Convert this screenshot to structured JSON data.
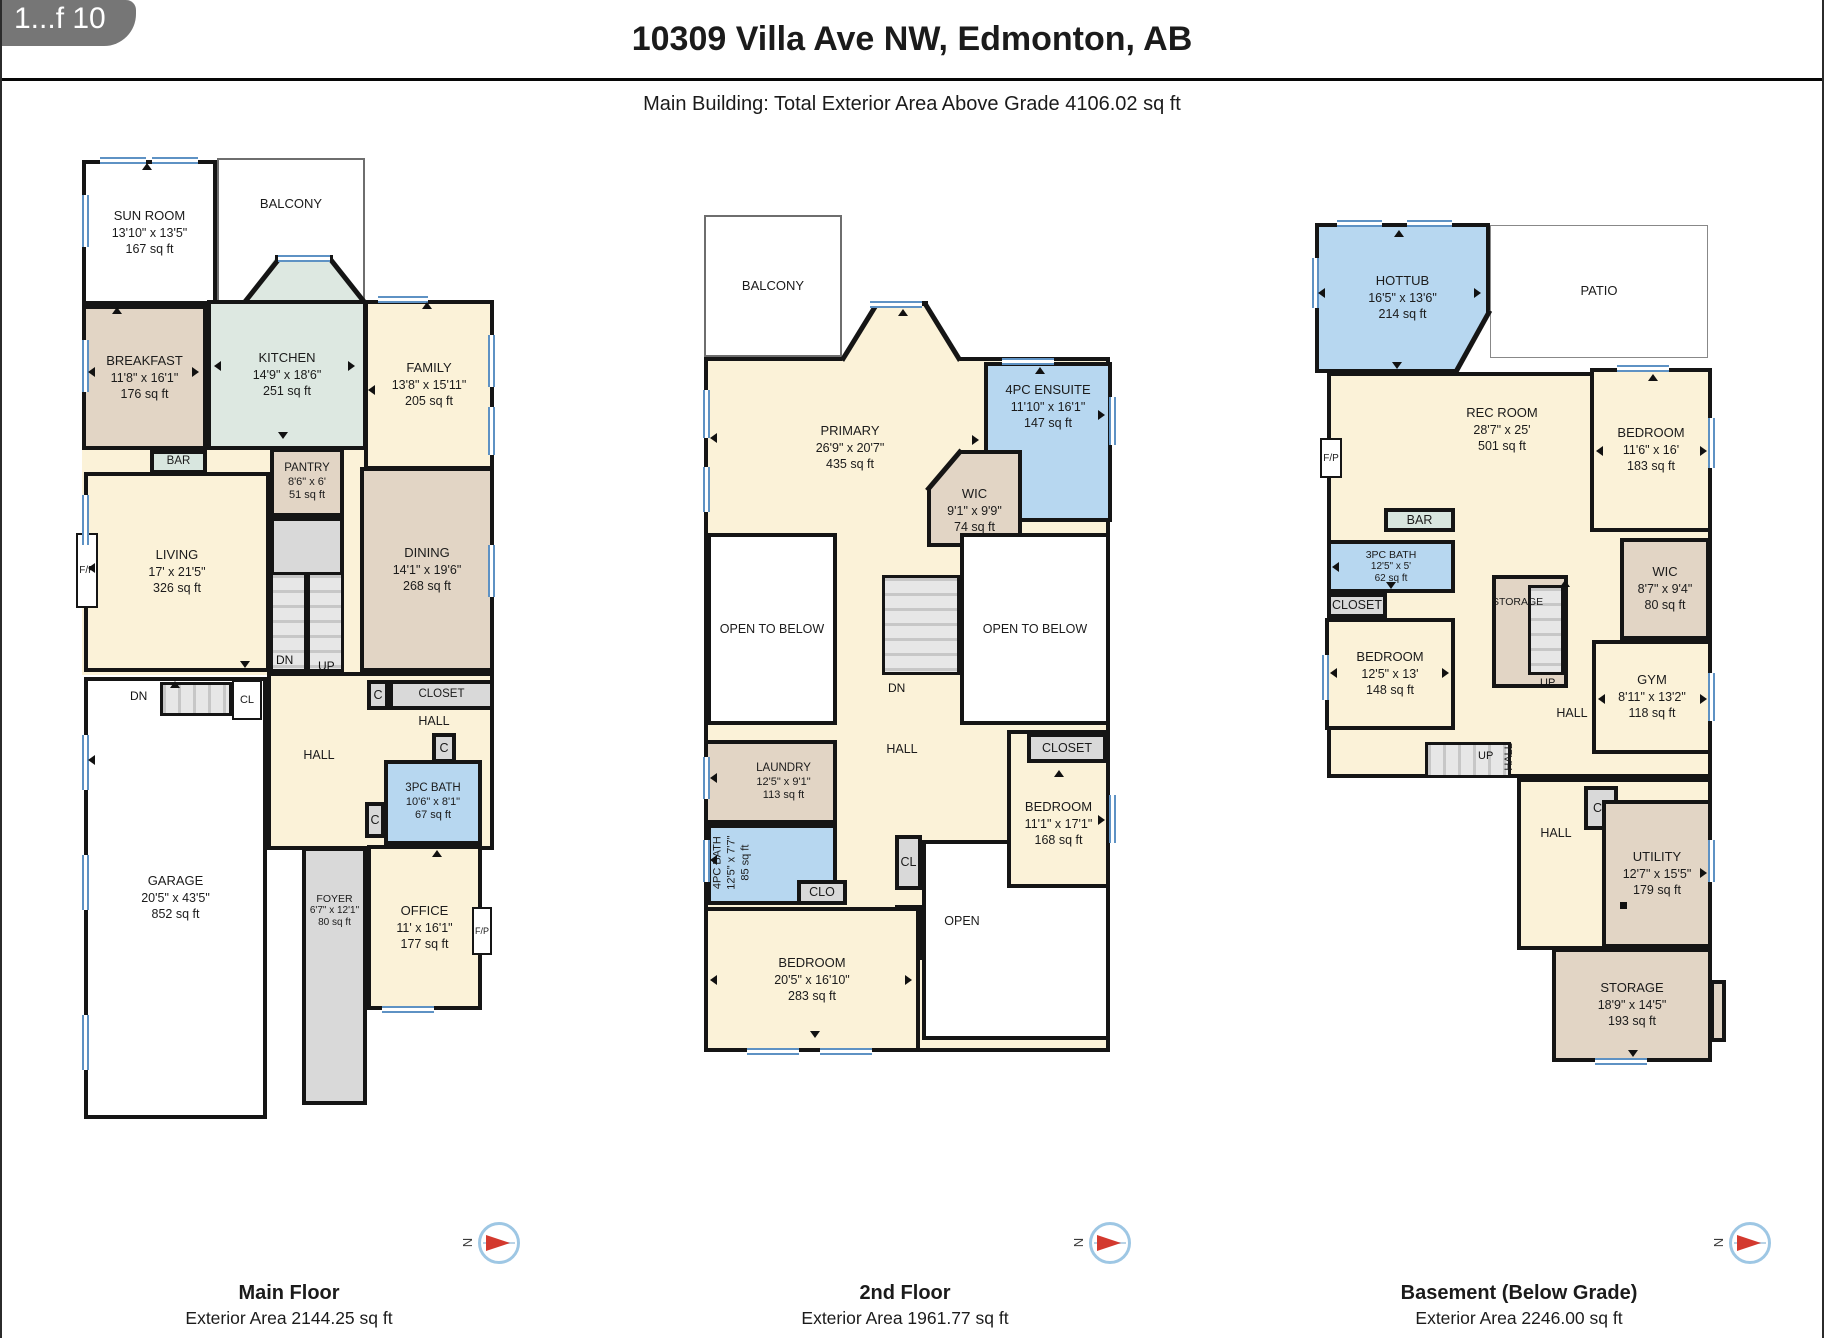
{
  "page": {
    "badge": "1...f 10",
    "title": "10309 Villa Ave NW, Edmonton, AB",
    "subtitle": "Main Building: Total Exterior Area Above Grade 4106.02 sq ft",
    "compass_n": "N"
  },
  "colors": {
    "wall": "#151515",
    "cream": "#fbf2d8",
    "tan": "#e2d5c5",
    "blue": "#b7d7f0",
    "green": "#dde8e1",
    "gray": "#d9d9d9",
    "bar_green": "#d8e6df",
    "window_blue": "#5e92c4",
    "compass_red": "#d3392e"
  },
  "floors": {
    "main": {
      "caption": {
        "title": "Main Floor",
        "area": "Exterior Area 2144.25 sq ft"
      },
      "rooms": {
        "sun_room": {
          "name": "SUN ROOM",
          "dims": "13'10\" x 13'5\"",
          "area": "167 sq ft"
        },
        "balcony": {
          "name": "BALCONY"
        },
        "kitchen": {
          "name": "KITCHEN",
          "dims": "14'9\" x 18'6\"",
          "area": "251 sq ft"
        },
        "breakfast": {
          "name": "BREAKFAST",
          "dims": "11'8\" x 16'1\"",
          "area": "176 sq ft"
        },
        "family": {
          "name": "FAMILY",
          "dims": "13'8\" x 15'11\"",
          "area": "205 sq ft"
        },
        "bar": {
          "name": "BAR"
        },
        "pantry": {
          "name": "PANTRY",
          "dims": "8'6\" x 6'",
          "area": "51 sq ft"
        },
        "living": {
          "name": "LIVING",
          "dims": "17' x 21'5\"",
          "area": "326 sq ft"
        },
        "dining": {
          "name": "DINING",
          "dims": "14'1\" x 19'6\"",
          "area": "268 sq ft"
        },
        "garage": {
          "name": "GARAGE",
          "dims": "20'5\" x 43'5\"",
          "area": "852 sq ft"
        },
        "closet": {
          "name": "CLOSET"
        },
        "hall": {
          "name": "HALL"
        },
        "hall_right": {
          "name": "HALL"
        },
        "bath": {
          "name": "3PC BATH",
          "dims": "10'6\" x 8'1\"",
          "area": "67 sq ft"
        },
        "foyer": {
          "name": "FOYER",
          "dims": "6'7\" x 12'1\"",
          "area": "80 sq ft"
        },
        "office": {
          "name": "OFFICE",
          "dims": "11' x 16'1\"",
          "area": "177 sq ft"
        }
      },
      "markers": {
        "fp": "F/P",
        "fp2": "F/P",
        "dn": "DN",
        "up": "UP",
        "dn2": "DN",
        "cl": "CL",
        "c1": "C",
        "c2": "C",
        "c3": "C"
      }
    },
    "second": {
      "caption": {
        "title": "2nd Floor",
        "area": "Exterior Area 1961.77 sq ft"
      },
      "rooms": {
        "balcony": {
          "name": "BALCONY"
        },
        "primary": {
          "name": "PRIMARY",
          "dims": "26'9\" x 20'7\"",
          "area": "435 sq ft"
        },
        "ensuite": {
          "name": "4PC ENSUITE",
          "dims": "11'10\" x 16'1\"",
          "area": "147 sq ft"
        },
        "wic": {
          "name": "WIC",
          "dims": "9'1\" x 9'9\"",
          "area": "74 sq ft"
        },
        "open_left": {
          "name": "OPEN TO BELOW"
        },
        "open_right": {
          "name": "OPEN TO BELOW"
        },
        "hall": {
          "name": "HALL"
        },
        "laundry": {
          "name": "LAUNDRY",
          "dims": "12'5\" x 9'1\"",
          "area": "113 sq ft"
        },
        "bath": {
          "name": "4PC BATH",
          "dims": "12'5\" x 7'7\"",
          "area": "85 sq ft"
        },
        "clo": {
          "name": "CLO"
        },
        "closet": {
          "name": "CLOSET"
        },
        "bedroom_right": {
          "name": "BEDROOM",
          "dims": "11'1\" x 17'1\"",
          "area": "168 sq ft"
        },
        "open": {
          "name": "OPEN"
        },
        "bedroom": {
          "name": "BEDROOM",
          "dims": "20'5\" x 16'10\"",
          "area": "283 sq ft"
        }
      },
      "markers": {
        "dn": "DN",
        "cl1": "CL",
        "cl2": "CL"
      }
    },
    "basement": {
      "caption": {
        "title": "Basement (Below Grade)",
        "area": "Exterior Area 2246.00 sq ft"
      },
      "rooms": {
        "hottub": {
          "name": "HOTTUB",
          "dims": "16'5\" x 13'6\"",
          "area": "214 sq ft"
        },
        "patio": {
          "name": "PATIO"
        },
        "rec": {
          "name": "REC ROOM",
          "dims": "28'7\" x 25'",
          "area": "501 sq ft"
        },
        "bedroom_right": {
          "name": "BEDROOM",
          "dims": "11'6\" x 16'",
          "area": "183 sq ft"
        },
        "wic": {
          "name": "WIC",
          "dims": "8'7\" x 9'4\"",
          "area": "80 sq ft"
        },
        "gym": {
          "name": "GYM",
          "dims": "8'11\" x 13'2\"",
          "area": "118 sq ft"
        },
        "bar": {
          "name": "BAR"
        },
        "bath": {
          "name": "3PC BATH",
          "dims": "12'5\" x 5'",
          "area": "62 sq ft"
        },
        "closet": {
          "name": "CLOSET"
        },
        "bedroom": {
          "name": "BEDROOM",
          "dims": "12'5\" x 13'",
          "area": "148 sq ft"
        },
        "storage_upper": {
          "name": "STORAGE"
        },
        "hall": {
          "name": "HALL"
        },
        "hall_v": {
          "name": "HALL"
        },
        "hall_lower": {
          "name": "HALL"
        },
        "utility": {
          "name": "UTILITY",
          "dims": "12'7\" x 15'5\"",
          "area": "179 sq ft"
        },
        "storage": {
          "name": "STORAGE",
          "dims": "18'9\" x 14'5\"",
          "area": "193 sq ft"
        }
      },
      "markers": {
        "fp": "F/P",
        "up1": "UP",
        "up2": "UP",
        "cl": "CL"
      }
    }
  }
}
